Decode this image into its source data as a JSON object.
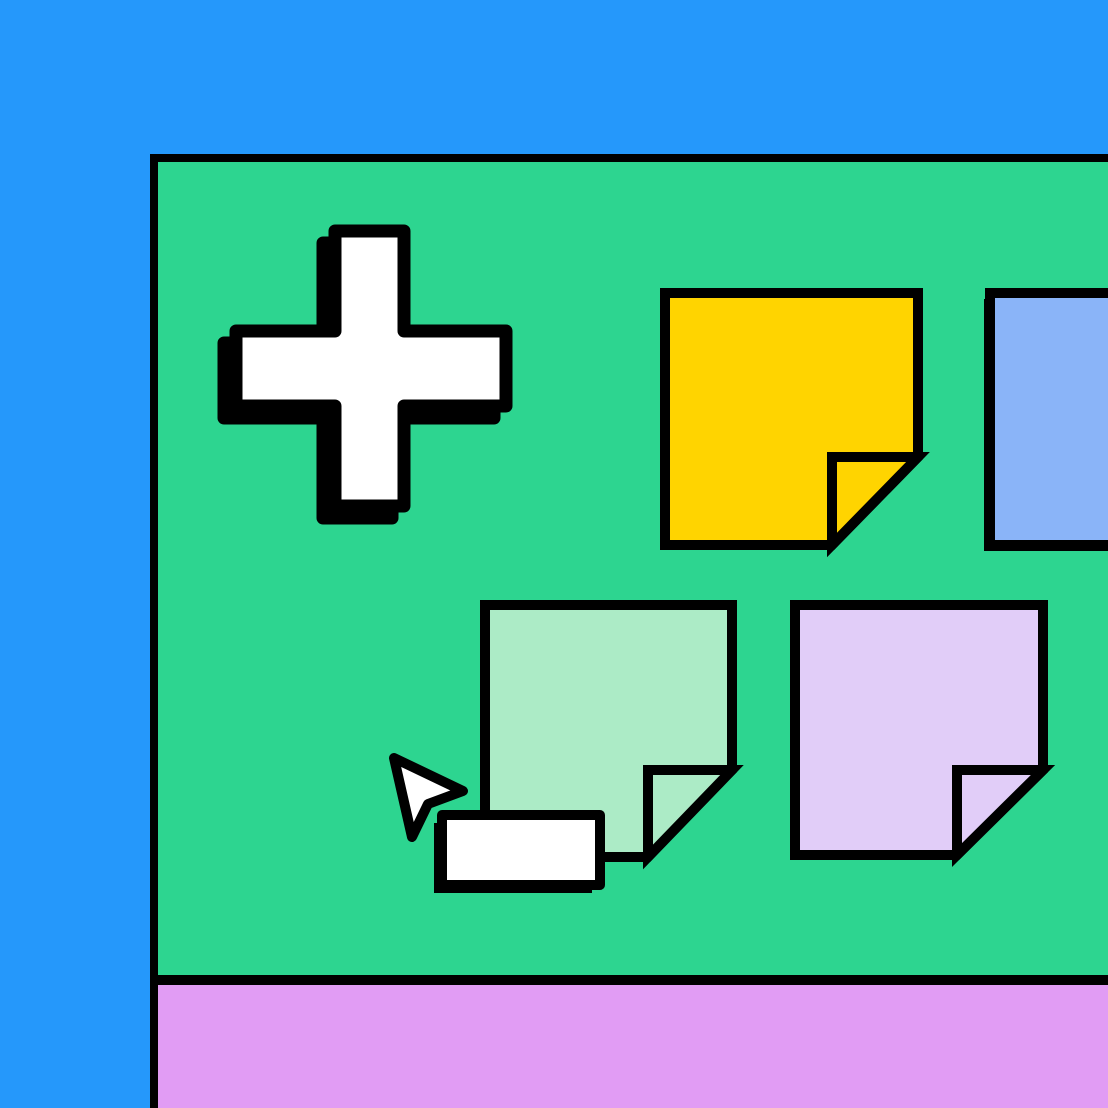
{
  "colors": {
    "background_blue": "#2598FB",
    "board_green": "#2DD590",
    "dock_purple": "#E19CF4",
    "outline_black": "#000000",
    "icon_white": "#FFFFFF",
    "shadow_black": "#000000",
    "note_yellow": "#FFD400",
    "note_periwinkle": "#8AB4F8",
    "note_mint": "#ACEBC6",
    "note_lavender": "#E1CDF8",
    "label_box_white": "#FFFFFF",
    "cursor_white": "#FFFFFF"
  },
  "board": {
    "notes": [
      {
        "id": "yellow",
        "color": "#FFD400",
        "folded_corner": true
      },
      {
        "id": "periwinkle",
        "color": "#8AB4F8",
        "folded_corner": false
      },
      {
        "id": "mint",
        "color": "#ACEBC6",
        "folded_corner": true
      },
      {
        "id": "lavender",
        "color": "#E1CDF8",
        "folded_corner": true
      }
    ],
    "label_box": {
      "text": ""
    }
  },
  "icons": [
    {
      "name": "plus-icon",
      "meaning": "add new note"
    },
    {
      "name": "cursor-pointer-icon",
      "meaning": "mouse pointer"
    }
  ]
}
